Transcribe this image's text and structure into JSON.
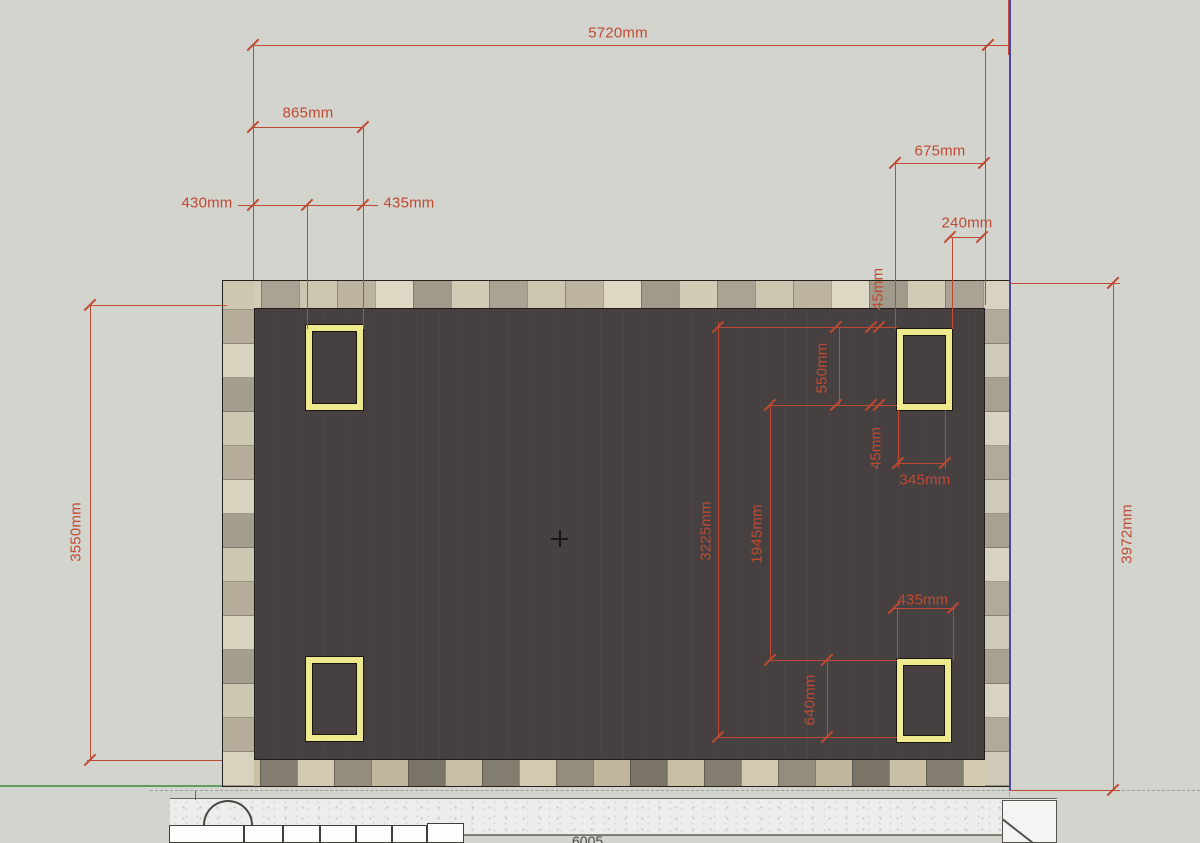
{
  "dims": {
    "d5720": "5720mm",
    "d865": "865mm",
    "d430": "430mm",
    "d435_top_left": "435mm",
    "d675": "675mm",
    "d240": "240mm",
    "d45_top": "45mm",
    "d550": "550mm",
    "d45_mid": "45mm",
    "d345": "345mm",
    "d3225": "3225mm",
    "d1945": "1945mm",
    "d435_bottom_right": "435mm",
    "d640": "640mm",
    "d3550": "3550mm",
    "d3972": "3972mm"
  },
  "bottom_text": "6005",
  "colors": {
    "background": "#d3d4cd",
    "dimension_red": "#bf4a33",
    "deck_surface": "#474041",
    "post_yellow": "#efe98e",
    "selected_edge_purple": "#4746ae",
    "axis_green": "#5f9e60",
    "tile_light": "#d2cbb6",
    "tile_dark": "#a19a8a"
  }
}
